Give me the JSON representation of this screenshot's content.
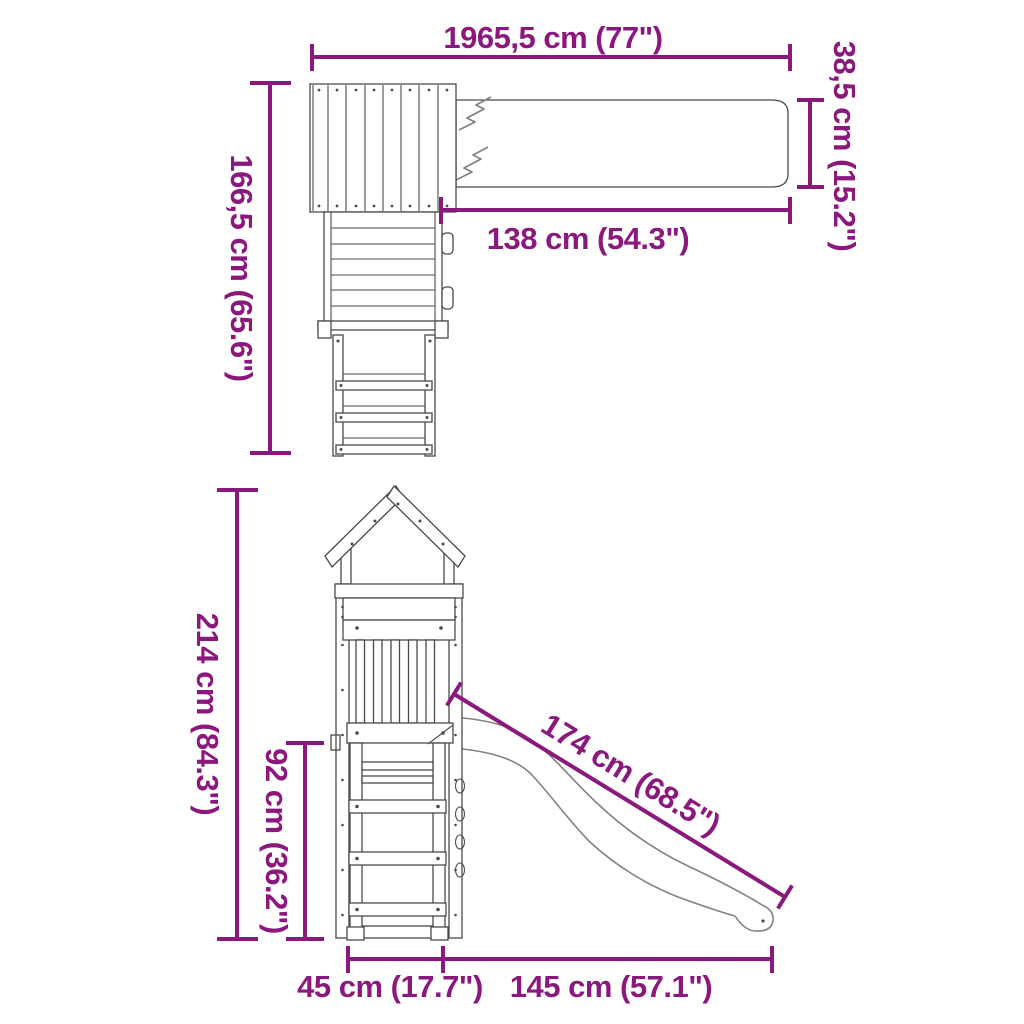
{
  "colors": {
    "accent": "#8A187D",
    "line": "#4A4A4A",
    "line_light": "#828282",
    "background": "#FFFFFF"
  },
  "diagram": {
    "top_view": {
      "dims": {
        "total_length": "1965,5 cm (77\")",
        "beam_width": "38,5 cm (15.2\")",
        "depth": "166,5 cm (65.6\")",
        "beam_length": "138 cm (54.3\")"
      }
    },
    "front_view": {
      "dims": {
        "total_height": "214 cm (84.3\")",
        "platform_height": "92 cm (36.2\")",
        "slide_length": "174 cm (68.5\")",
        "tower_width": "45 cm (17.7\")",
        "slide_reach": "145 cm (57.1\")"
      }
    }
  }
}
